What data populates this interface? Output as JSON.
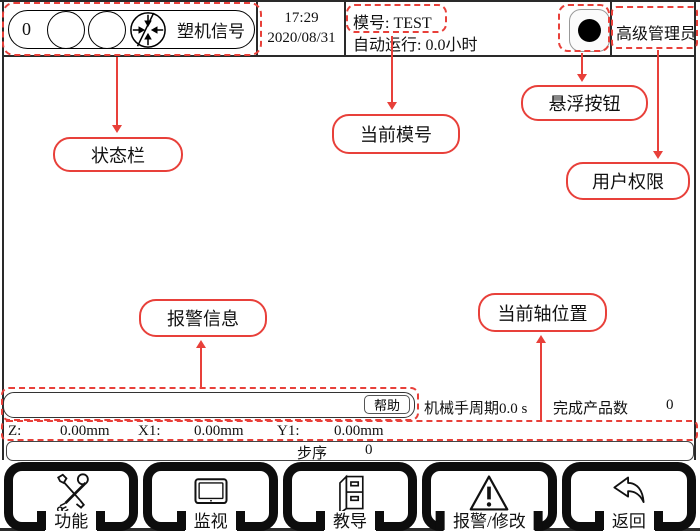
{
  "colors": {
    "annotation_red": "#e8403a",
    "text": "#111111"
  },
  "top_bar": {
    "status": {
      "count": "0",
      "signal_label": "塑机信号"
    },
    "time": "17:29",
    "date": "2020/08/31",
    "mold_label": "模号: TEST",
    "auto_run_label": "自动运行: 0.0小时",
    "user_role": "高级管理员"
  },
  "callouts": [
    {
      "label": "状态栏"
    },
    {
      "label": "当前模号"
    },
    {
      "label": "悬浮按钮"
    },
    {
      "label": "用户权限"
    },
    {
      "label": "报警信息"
    },
    {
      "label": "当前轴位置"
    }
  ],
  "alarm_bar": {
    "message": "",
    "help_button": "帮助"
  },
  "info_row": {
    "cycle_label": "机械手周期",
    "cycle_value": "0.0 s",
    "product_label": "完成产品数",
    "product_count": "0"
  },
  "axis_row": {
    "z_label": "Z:",
    "z_value": "0.00mm",
    "x1_label": "X1:",
    "x1_value": "0.00mm",
    "y1_label": "Y1:",
    "y1_value": "0.00mm"
  },
  "step_row": {
    "label": "步序",
    "value": "0"
  },
  "toolbar": {
    "buttons": [
      {
        "label": "功能",
        "icon": "tools-icon"
      },
      {
        "label": "监视",
        "icon": "monitor-icon"
      },
      {
        "label": "教导",
        "icon": "cabinet-icon"
      },
      {
        "label": "报警/修改",
        "icon": "warning-icon"
      },
      {
        "label": "返回",
        "icon": "back-arrow-icon"
      }
    ]
  }
}
